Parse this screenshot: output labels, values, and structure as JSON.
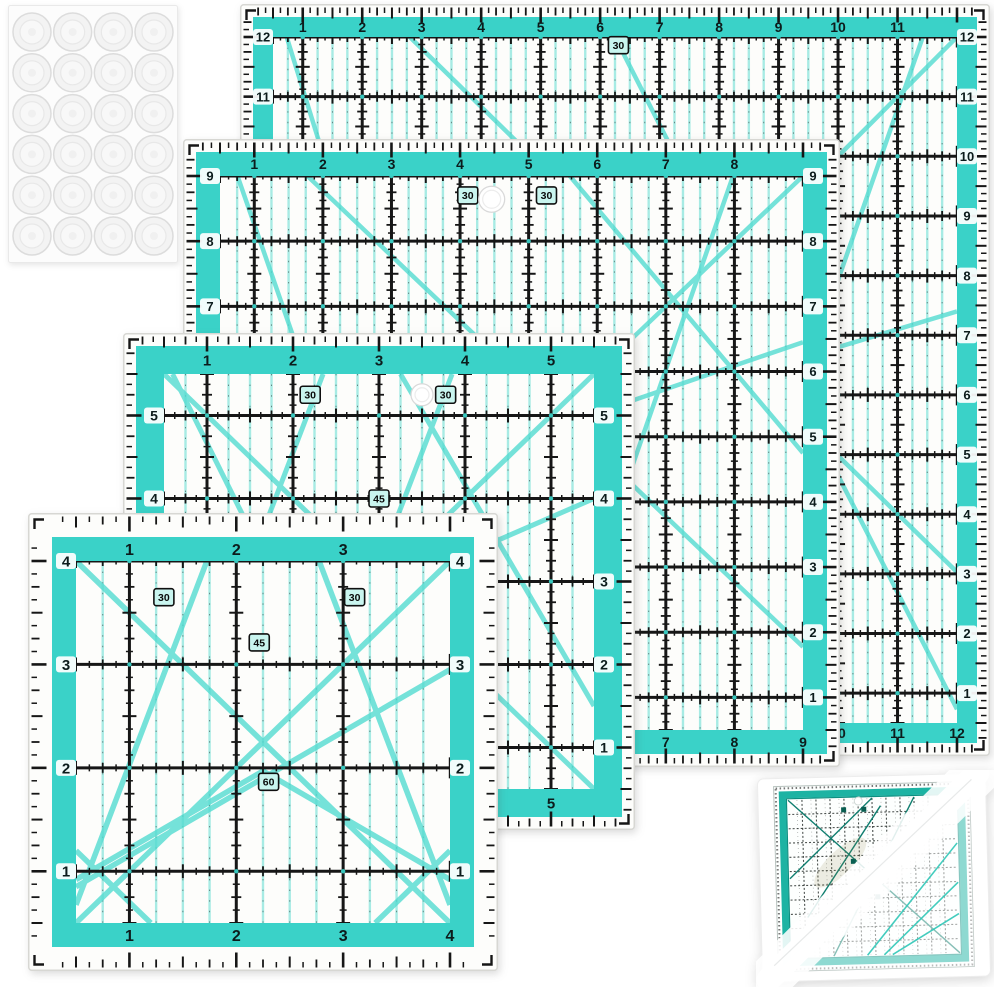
{
  "scene": {
    "width": 994,
    "height": 987,
    "background": "#ffffff"
  },
  "colors": {
    "acrylic": "#fdfdfb",
    "edge": "#d7d7d3",
    "teal": "#3ad2c8",
    "stripe": "#a7ebe4",
    "diag": "#54dcd1",
    "black": "#161616",
    "label": "#0c1c1c",
    "badge": "#c9f5ef"
  },
  "grip_sheet": {
    "id": "grip-dot-sheet",
    "x": 8,
    "y": 5,
    "w": 170,
    "h": 258,
    "rows": 6,
    "cols": 4,
    "dot_r": 19,
    "sheet_fill": "#fcfcfc",
    "sheet_edge": "#e9e9e9",
    "dot_edge": "#dcdcdc",
    "dot_fill": "#f3f3f3"
  },
  "rulers": [
    {
      "id": "ruler-12-5-inch",
      "x": 240,
      "y": 4,
      "w": 750,
      "h": 752,
      "m": 13,
      "b": 20,
      "span": 11.5,
      "side_top": 12,
      "fs1": 14,
      "fs2": 13,
      "dw": 4.5,
      "top_labels": [
        "1",
        "2",
        "3",
        "4",
        "5",
        "6",
        "7",
        "8",
        "9",
        "10",
        "11"
      ],
      "side_labels": [
        "12",
        "11",
        "10",
        "9",
        "8",
        "7",
        "6",
        "5",
        "4",
        "3",
        "2",
        "1"
      ],
      "bottom_labels": [
        "1",
        "2",
        "3",
        "4",
        "5",
        "6",
        "7",
        "8",
        "9",
        "10",
        "11",
        "12"
      ],
      "badges": [
        {
          "label": "30",
          "fx": 0.505,
          "fy": 0.012
        }
      ],
      "hole": null,
      "diagonals": [
        [
          0,
          1,
          1,
          0
        ],
        [
          0.02,
          0,
          0.33,
          1
        ],
        [
          0.6,
          1,
          0.95,
          0
        ],
        [
          0,
          0.7,
          1,
          0.4
        ],
        [
          0.2,
          0,
          1,
          0.78
        ],
        [
          0.5,
          0,
          1,
          0.98
        ],
        [
          0,
          0.25,
          0.45,
          1
        ]
      ]
    },
    {
      "id": "ruler-9-5-inch",
      "x": 183,
      "y": 139,
      "w": 657,
      "h": 628,
      "m": 13,
      "b": 24,
      "span": 8.5,
      "side_top": 9,
      "fs1": 14,
      "fs2": 13,
      "dw": 4.5,
      "top_labels": [
        "1",
        "2",
        "3",
        "4",
        "5",
        "6",
        "7",
        "8"
      ],
      "side_labels": [
        "9",
        "8",
        "7",
        "6",
        "5",
        "4",
        "3",
        "2",
        "1"
      ],
      "bottom_labels": [
        "1",
        "2",
        "3",
        "4",
        "5",
        "6",
        "7",
        "8",
        "9"
      ],
      "badges": [
        {
          "label": "30",
          "fx": 0.425,
          "fy": 0.035
        },
        {
          "label": "30",
          "fx": 0.56,
          "fy": 0.035
        }
      ],
      "hole": {
        "fx": 0.466,
        "fy": 0.042,
        "r": 13
      },
      "diagonals": [
        [
          0,
          1,
          1,
          0
        ],
        [
          0.03,
          0,
          0.36,
          1
        ],
        [
          0.55,
          1,
          0.88,
          0
        ],
        [
          0,
          0.66,
          1,
          0.3
        ],
        [
          0.15,
          0,
          1,
          0.85
        ],
        [
          0,
          0.3,
          0.5,
          1
        ],
        [
          0.6,
          0,
          1,
          0.5
        ]
      ]
    },
    {
      "id": "ruler-6-5-inch",
      "x": 123,
      "y": 333,
      "w": 512,
      "h": 497,
      "m": 13,
      "b": 28,
      "span": 5,
      "side_top": 5.5,
      "fs1": 15,
      "fs2": 14,
      "dw": 5,
      "top_labels": [
        "1",
        "2",
        "3",
        "4",
        "5"
      ],
      "side_labels": [
        "5",
        "4",
        "3",
        "2",
        "1"
      ],
      "bottom_labels": [
        "1",
        "2",
        "3",
        "4",
        "5"
      ],
      "badges": [
        {
          "label": "30",
          "fx": 0.34,
          "fy": 0.05
        },
        {
          "label": "30",
          "fx": 0.655,
          "fy": 0.05
        },
        {
          "label": "45",
          "fx": 0.5,
          "fy": 0.3
        }
      ],
      "hole": {
        "fx": 0.6,
        "fy": 0.05,
        "r": 11
      },
      "diagonals": [
        [
          0,
          1,
          1,
          0
        ],
        [
          0,
          0,
          1,
          1
        ],
        [
          0,
          1,
          0.37,
          0
        ],
        [
          0.3,
          1,
          0.67,
          0
        ],
        [
          0.02,
          0,
          0.5,
          1
        ],
        [
          0,
          0.75,
          1,
          0.3
        ],
        [
          0.55,
          0,
          1,
          0.8
        ]
      ]
    },
    {
      "id": "ruler-4-5-inch",
      "x": 28,
      "y": 513,
      "w": 470,
      "h": 458,
      "m": 24,
      "b": 24,
      "span": 3.5,
      "side_top": 4,
      "fs1": 16,
      "fs2": 15,
      "dw": 5.5,
      "top_labels": [
        "1",
        "2",
        "3"
      ],
      "side_labels": [
        "4",
        "3",
        "2",
        "1"
      ],
      "bottom_labels": [
        "1",
        "2",
        "3",
        "4"
      ],
      "badges": [
        {
          "label": "30",
          "fx": 0.235,
          "fy": 0.1
        },
        {
          "label": "30",
          "fx": 0.745,
          "fy": 0.1
        },
        {
          "label": "45",
          "fx": 0.49,
          "fy": 0.225
        },
        {
          "label": "60",
          "fx": 0.515,
          "fy": 0.61
        }
      ],
      "hole": null,
      "diagonals": [
        [
          0,
          0.95,
          0.35,
          0
        ],
        [
          1,
          0.95,
          0.65,
          0
        ],
        [
          0,
          1,
          1,
          0
        ],
        [
          0,
          0,
          1,
          1
        ],
        [
          0,
          0.9,
          1,
          0.3
        ],
        [
          0,
          0.88,
          0.5,
          0.58
        ],
        [
          0.5,
          0.58,
          1,
          0.88
        ],
        [
          0,
          0.8,
          0.2,
          1
        ],
        [
          0.8,
          1,
          1,
          0.8
        ]
      ]
    }
  ],
  "small_ruler": {
    "id": "small-square-ruler",
    "x": 756,
    "y": 770,
    "w": 238,
    "h": 217,
    "rotate": -1.5,
    "sheet_fill": "#ffffff",
    "sheet_edge": "#ededed",
    "frame_color": "#1db3a3",
    "frame_dark": "#0d8f81",
    "grid_color": "#2c3330",
    "diag_green": "#0f7e6f",
    "diag_teal": "#2fc7b7",
    "cols": 12,
    "rows": 11,
    "marks": [
      [
        0.33,
        0.07
      ],
      [
        0.45,
        0.07
      ],
      [
        0.38,
        0.4
      ],
      [
        0.52,
        0.63
      ]
    ],
    "hole": {
      "fx": 0.43,
      "fy": 0.09,
      "r": 4
    }
  }
}
